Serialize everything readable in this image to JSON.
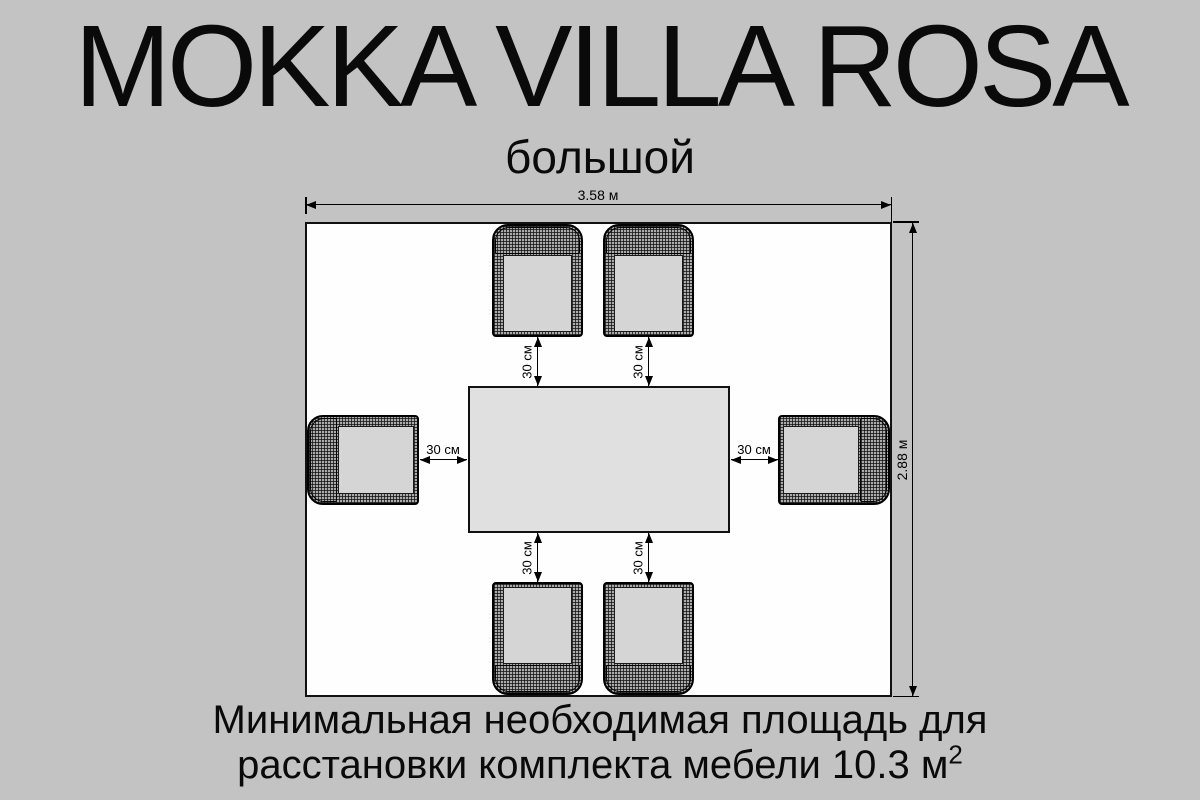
{
  "title": "MOKKA VILLA ROSA",
  "subtitle": "большой",
  "dimensions": {
    "width_label": "3.58 м",
    "height_label": "2.88 м",
    "clearances": {
      "top_left": "30 см",
      "top_right": "30 см",
      "bottom_left": "30 см",
      "bottom_right": "30 см",
      "left": "30 см",
      "right": "30 см"
    }
  },
  "footer": {
    "line1": "Минимальная необходимая площадь для",
    "line2_text": "расстановки комплекта мебели 10.3 м",
    "line2_sup": "2"
  },
  "plan": {
    "room": {
      "width_m": "3.58",
      "depth_m": "2.88"
    },
    "table": {
      "shape": "rectangle"
    },
    "chairs": [
      {
        "position": "top-left"
      },
      {
        "position": "top-right"
      },
      {
        "position": "left"
      },
      {
        "position": "right"
      },
      {
        "position": "bottom-left"
      },
      {
        "position": "bottom-right"
      }
    ],
    "clearance_cm": "30"
  },
  "colors": {
    "background": "#c3c3c3",
    "room_fill": "#fefefe",
    "table_fill": "#e0e0e0",
    "seat_fill": "#d5d5d5",
    "hatch_base": "#ababab",
    "line": "#000000"
  }
}
